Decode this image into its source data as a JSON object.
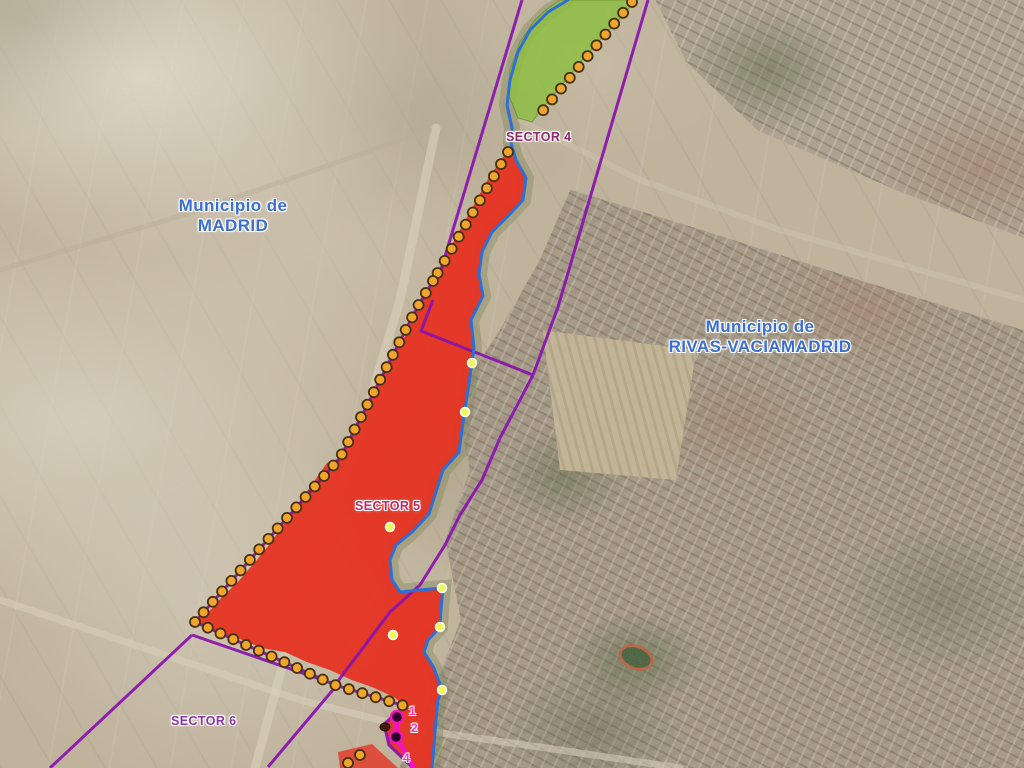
{
  "map": {
    "region_labels": {
      "madrid": {
        "line1": "Municipio de",
        "line2": "MADRID"
      },
      "rivas": {
        "line1": "Municipio de",
        "line2": "RIVAS-VACIAMADRID"
      }
    },
    "sector_labels": {
      "sector4": "SECTOR 4",
      "sector5": "SECTOR 5",
      "sector6": "SECTOR 6"
    },
    "vertex_labels": {
      "v1": "1",
      "v2": "2",
      "v4": "4"
    },
    "colors": {
      "municipality_label_blue": "#3A6ED0",
      "sector4_label": "#93256A",
      "sector5_label": "#C12A62",
      "sector6_label": "#8833A6",
      "vertex_label_magenta": "#FF2FBE",
      "boundary_purple": "#8912AE",
      "river_blue": "#2E6FD4",
      "sector_red_fill": "#E63323",
      "green_area_fill": "#8CBE3F",
      "boundary_dot_orange": "#F2A52C",
      "boundary_dot_outline": "#44320F",
      "river_dot_yellow": "#EEF857",
      "highlight_magenta": "#F513BC"
    }
  }
}
